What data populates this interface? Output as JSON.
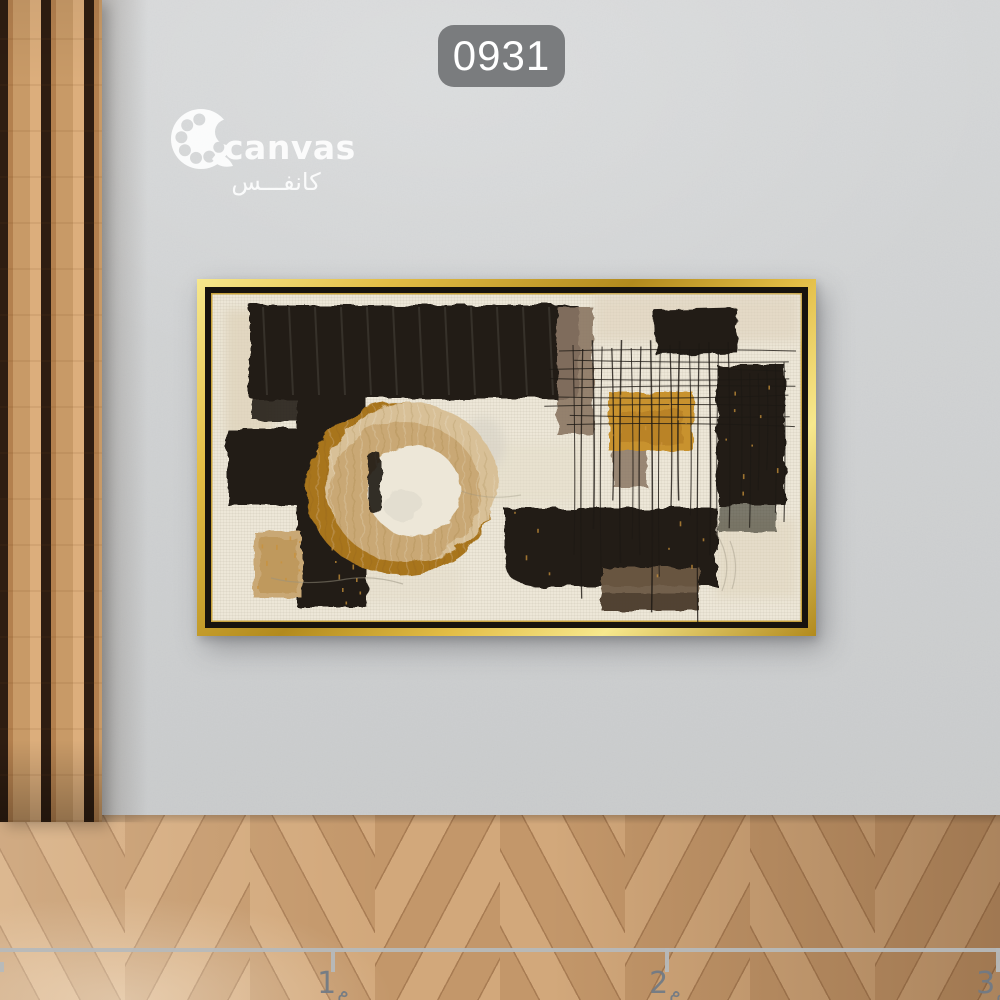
{
  "badge": {
    "code": "0931"
  },
  "logo": {
    "icon": "palette-icon",
    "brand_en": "canvas",
    "brand_ar": "كانفـــس"
  },
  "artwork": {
    "description": "abstract painting with black brush blocks, gold ring and ochre squares on cream canvas in gold frame"
  },
  "ruler": {
    "marks": [
      {
        "num": "1",
        "unit": "م"
      },
      {
        "num": "2",
        "unit": "م"
      },
      {
        "num": "3",
        "unit": "م"
      }
    ]
  },
  "colors": {
    "wall": "#d3d5d6",
    "slat_wood": "#c89a67",
    "slat_wood_light": "#dcae7c",
    "slat_wood_dark": "#b3804e",
    "slat_groove": "#2e1d11",
    "floor_light": "#d2a87b",
    "floor_mid": "#c3976a",
    "floor_seam": "#a87c53",
    "badge_bg": "#7a7c7e",
    "badge_text": "#ffffff",
    "logo_white": "#ffffff",
    "frame_gold_1": "#f7e88d",
    "frame_gold_2": "#e3bd45",
    "frame_gold_3": "#b28a1d",
    "frame_black": "#17130e",
    "canvas_cream": "#ede7d8",
    "art_black": "#221d18",
    "art_tan": "#c9a874",
    "art_tan_light": "#d8c097",
    "art_ochre": "#a8741f",
    "art_gold": "#c8922e",
    "art_taupe": "#8a7663",
    "art_beige": "#ddd1ba",
    "art_sage": "#b2b7a6",
    "art_brown": "#6b5843",
    "ruler_line": "#b6b9bb",
    "ruler_text": "#6f7a86"
  }
}
